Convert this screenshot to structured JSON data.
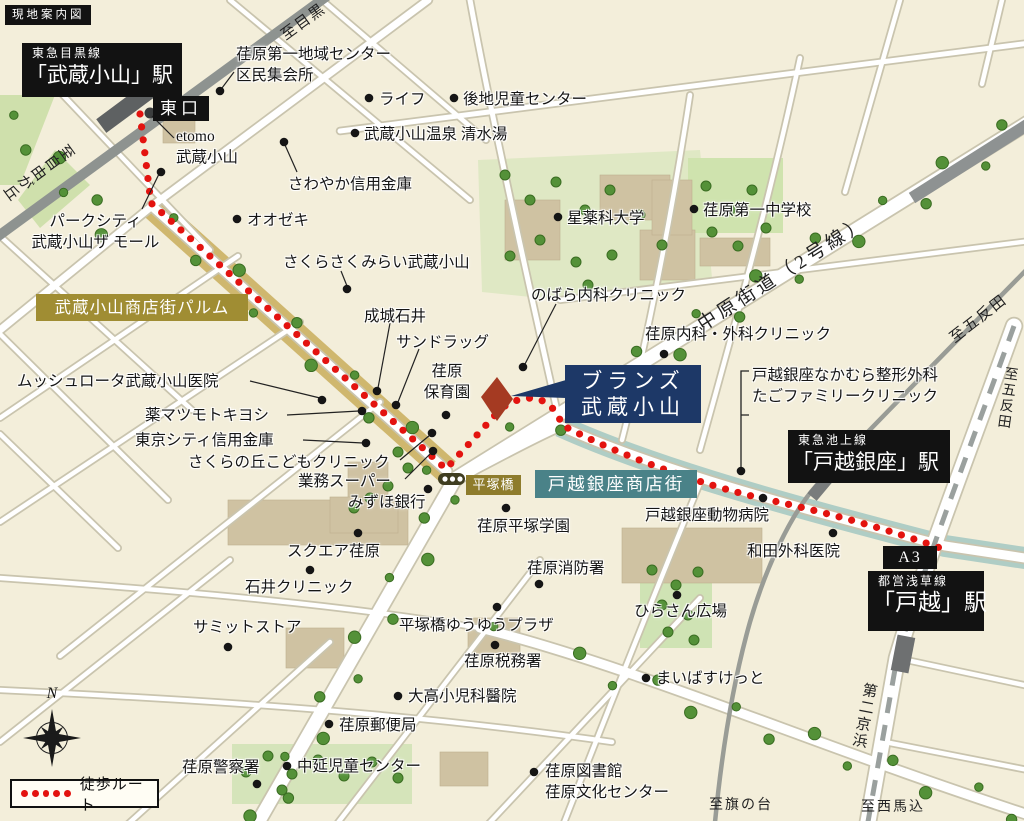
{
  "map": {
    "title": "現地案内図",
    "compass_north": "N",
    "legend": {
      "walk_route_label": "徒歩ルート"
    },
    "route_color": "#e3130f",
    "property_marker": {
      "line1": "ブランズ",
      "line2": "武蔵小山",
      "box_color": "#1d3867",
      "building_color": "#a53a22"
    },
    "stations": {
      "meguro_line": {
        "line": "東急目黒線",
        "name": "「武蔵小山」駅",
        "exit": "東口"
      },
      "ikegami_line": {
        "line": "東急池上線",
        "name": "「戸越銀座」駅"
      },
      "asakusa_line": {
        "line": "都営浅草線",
        "name": "「戸越」駅",
        "exit": "A3"
      }
    },
    "street_banners": [
      {
        "id": "palm",
        "label": "武蔵小山商店街パルム",
        "color": "#a08d33"
      },
      {
        "id": "togoshiginza",
        "label": "戸越銀座商店街",
        "color": "#4a8288"
      },
      {
        "id": "hiratsukabashi",
        "label": "平塚橋",
        "color": "#8e7c2c"
      }
    ],
    "directions": [
      "至目黒",
      "至自由が丘",
      "中原街道（2号線）",
      "至五反田",
      "至五反田",
      "第二京浜",
      "至西馬込",
      "至旗の台"
    ],
    "pois": [
      {
        "id": "ebara1center",
        "label": "荏原第一地域センター\n区民集会所"
      },
      {
        "id": "life",
        "label": "ライフ"
      },
      {
        "id": "gochi",
        "label": "後地児童センター"
      },
      {
        "id": "onsen",
        "label": "武蔵小山温泉 清水湯"
      },
      {
        "id": "etomo",
        "label": "etomo\n武蔵小山"
      },
      {
        "id": "sawayaka",
        "label": "さわやか信用金庫"
      },
      {
        "id": "oozeki",
        "label": "オオゼキ"
      },
      {
        "id": "parkcity",
        "label": "パークシティ\n武蔵小山ザ モール"
      },
      {
        "id": "sakurasaku",
        "label": "さくらさくみらい武蔵小山"
      },
      {
        "id": "seijoishii",
        "label": "成城石井"
      },
      {
        "id": "sundrug",
        "label": "サンドラッグ"
      },
      {
        "id": "hoikuen",
        "label": "荏原\n保育園"
      },
      {
        "id": "nobara",
        "label": "のばら内科クリニック"
      },
      {
        "id": "hoshiyakka",
        "label": "星薬科大学"
      },
      {
        "id": "ebara1chu",
        "label": "荏原第一中学校"
      },
      {
        "id": "ebaranaika",
        "label": "荏原内科・外科クリニック"
      },
      {
        "id": "nakamura",
        "label": "戸越銀座なかむら整形外科\nたごファミリークリニック"
      },
      {
        "id": "mussyu",
        "label": "ムッシュロータ武蔵小山医院"
      },
      {
        "id": "matsukiyo",
        "label": "薬マツモトキヨシ"
      },
      {
        "id": "tokyocity",
        "label": "東京シティ信用金庫"
      },
      {
        "id": "sakuranooka",
        "label": "さくらの丘こどもクリニック"
      },
      {
        "id": "gyomu",
        "label": "業務スーパー"
      },
      {
        "id": "mizuho",
        "label": "みずほ銀行"
      },
      {
        "id": "hiratsukagakuen",
        "label": "荏原平塚学園"
      },
      {
        "id": "doubutsu",
        "label": "戸越銀座動物病院"
      },
      {
        "id": "wada",
        "label": "和田外科医院"
      },
      {
        "id": "squareebara",
        "label": "スクエア荏原"
      },
      {
        "id": "ishii",
        "label": "石井クリニック"
      },
      {
        "id": "shobosho",
        "label": "荏原消防署"
      },
      {
        "id": "hirasan",
        "label": "ひらさん広場"
      },
      {
        "id": "summit",
        "label": "サミットストア"
      },
      {
        "id": "yuyuplaza",
        "label": "平塚橋ゆうゆうプラザ"
      },
      {
        "id": "zeimusho",
        "label": "荏原税務署"
      },
      {
        "id": "maibasuketto",
        "label": "まいばすけっと"
      },
      {
        "id": "otaka",
        "label": "大高小児科醫院"
      },
      {
        "id": "yubin",
        "label": "荏原郵便局"
      },
      {
        "id": "keisatsu",
        "label": "荏原警察署"
      },
      {
        "id": "nakanobu",
        "label": "中延児童センター"
      },
      {
        "id": "toshokan",
        "label": "荏原図書館\n荏原文化センター"
      }
    ]
  }
}
